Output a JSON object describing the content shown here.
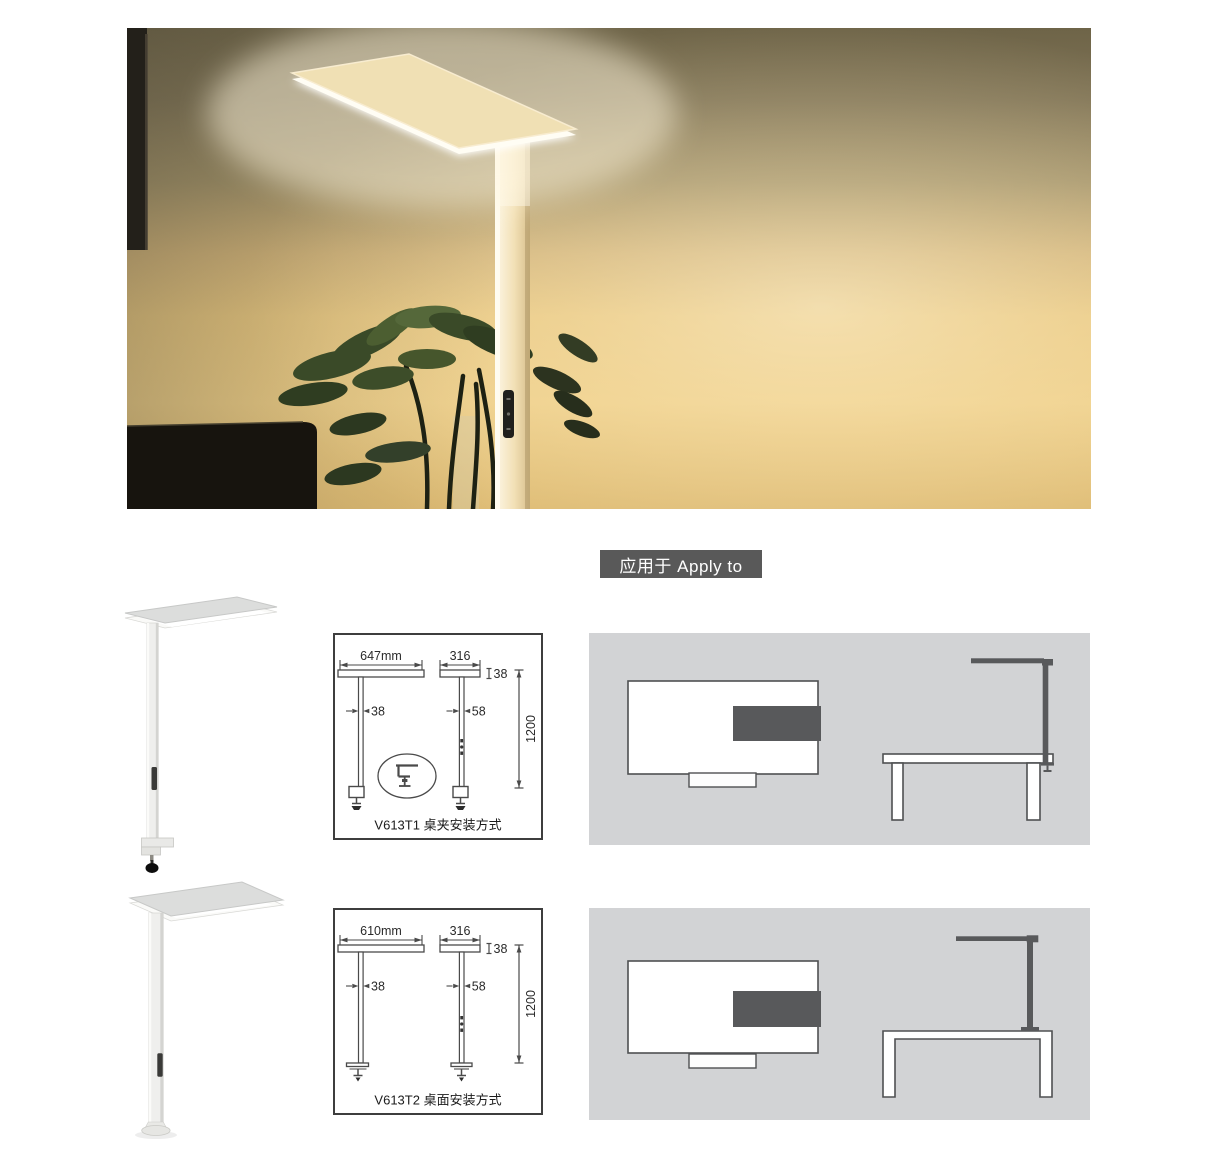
{
  "apply_badge": {
    "label": "应用于 Apply to",
    "bg_color": "#595959",
    "text_color": "#ffffff"
  },
  "products": [
    {
      "model": "V613T1",
      "caption": "V613T1 桌夹安装方式",
      "dims": {
        "head_width": "647mm",
        "head_depth": "316",
        "head_thickness": "38",
        "pole_width_front": "38",
        "pole_width_side": "58",
        "mount_height": "1200"
      }
    },
    {
      "model": "V613T2",
      "caption": "V613T2 桌面安装方式",
      "dims": {
        "head_width": "610mm",
        "head_depth": "316",
        "head_thickness": "38",
        "pole_width_front": "38",
        "pole_width_side": "58",
        "mount_height": "1200"
      }
    }
  ],
  "colors": {
    "badge_bg": "#595959",
    "panel_bg": "#d2d3d5",
    "silhouette": "#58595b",
    "diagram_line": "#4a4a4a",
    "photo_wall_top": "#6e6448",
    "photo_wall_gold": "#e9c77f",
    "lamp_glow": "#fffdf2"
  }
}
